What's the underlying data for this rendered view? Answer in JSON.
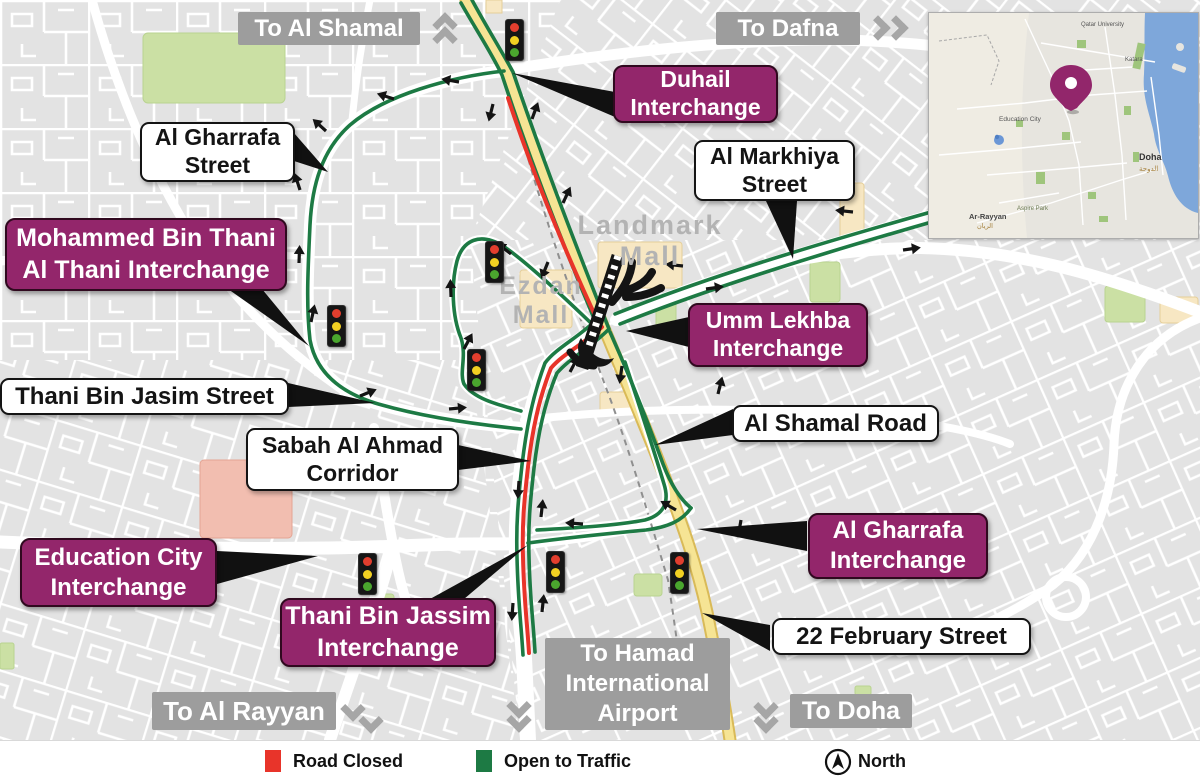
{
  "directions": {
    "to_al_shamal": {
      "label": "To Al Shamal"
    },
    "to_dafna": {
      "label": "To Dafna"
    },
    "to_al_rayyan": {
      "label": "To Al Rayyan"
    },
    "to_doha": {
      "label": "To Doha"
    },
    "to_hamad": {
      "lines": [
        "To Hamad",
        "International",
        "Airport"
      ]
    }
  },
  "interchanges": {
    "duhail": {
      "lines": [
        "Duhail",
        "Interchange"
      ]
    },
    "mohammed_bin_thani": {
      "lines": [
        "Mohammed Bin Thani",
        "Al Thani Interchange"
      ]
    },
    "umm_lekhba": {
      "lines": [
        "Umm Lekhba",
        "Interchange"
      ]
    },
    "education_city": {
      "lines": [
        "Education City",
        "Interchange"
      ]
    },
    "thani_bin_jassim": {
      "lines": [
        "Thani Bin Jassim",
        "Interchange"
      ]
    },
    "al_gharrafa": {
      "lines": [
        "Al Gharrafa",
        "Interchange"
      ]
    }
  },
  "streets": {
    "al_gharrafa_street": {
      "lines": [
        "Al Gharrafa",
        "Street"
      ]
    },
    "al_markhiya_street": {
      "lines": [
        "Al Markhiya",
        "Street"
      ]
    },
    "thani_bin_jasim_street": {
      "label": "Thani Bin Jasim Street"
    },
    "sabah_al_ahmad": {
      "lines": [
        "Sabah Al Ahmad",
        "Corridor"
      ]
    },
    "al_shamal_road": {
      "label": "Al Shamal Road"
    },
    "feb22_street": {
      "label": "22 February Street"
    }
  },
  "places": {
    "landmark_mall": {
      "lines": [
        "Landmark",
        "Mall"
      ]
    },
    "ezdan_mall": {
      "lines": [
        "Ezdan",
        "Mall"
      ]
    }
  },
  "legend": {
    "road_closed": "Road Closed",
    "open_to_traffic": "Open to Traffic",
    "north": "North"
  },
  "inset": {
    "labels": {
      "doha": "Doha",
      "doha_ar": "الدوحة",
      "ar_rayyan": "Ar-Rayyan",
      "ar_rayyan_ar": "الريان",
      "education_city": "Education City",
      "qatar_university": "Qatar University",
      "katara": "Katara",
      "aspire_park": "Aspire Park"
    }
  },
  "colors": {
    "closed": "#e8342a",
    "open": "#1d7a44",
    "interchange_badge": "#93266b",
    "road_yellow": "#f6e494",
    "traffic_light_red": "#e23e2e",
    "traffic_light_yellow": "#f2d022",
    "traffic_light_green": "#4aa62e"
  }
}
